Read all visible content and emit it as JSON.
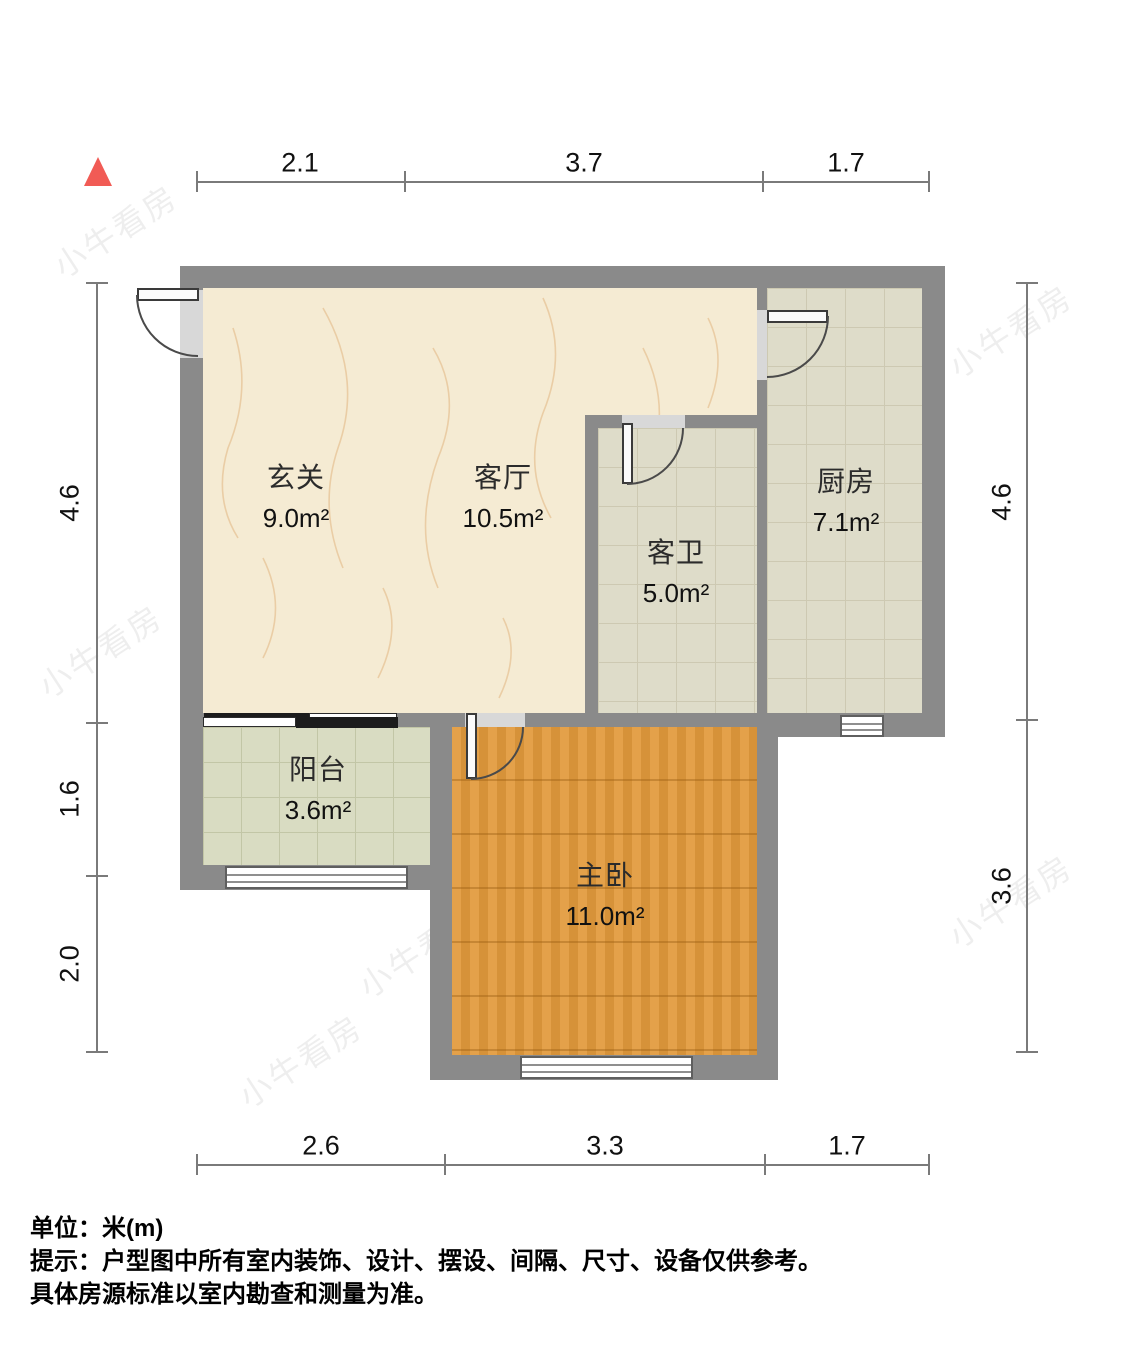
{
  "north_indicator": {
    "color": "#f15b55"
  },
  "dimensions": {
    "top": [
      "2.1",
      "3.7",
      "1.7"
    ],
    "bottom": [
      "2.6",
      "3.3",
      "1.7"
    ],
    "left": [
      "4.6",
      "1.6",
      "2.0"
    ],
    "right": [
      "4.6",
      "3.6"
    ]
  },
  "rooms": [
    {
      "id": "entry",
      "name": "玄关",
      "area": "9.0m²"
    },
    {
      "id": "living",
      "name": "客厅",
      "area": "10.5m²"
    },
    {
      "id": "bath",
      "name": "客卫",
      "area": "5.0m²"
    },
    {
      "id": "kitchen",
      "name": "厨房",
      "area": "7.1m²"
    },
    {
      "id": "balcony",
      "name": "阳台",
      "area": "3.6m²"
    },
    {
      "id": "bedroom",
      "name": "主卧",
      "area": "11.0m²"
    }
  ],
  "watermark": {
    "text": "小牛看房"
  },
  "footer": {
    "units_line": "单位：米(m)",
    "disclaimer_line1": "提示：户型图中所有室内装饰、设计、摆设、间隔、尺寸、设备仅供参考。",
    "disclaimer_line2": "具体房源标准以室内勘查和测量为准。"
  },
  "colors": {
    "wall": "#8a8a8a",
    "living_floor": "#f5ebd3",
    "tile_floor": "#dedcc9",
    "balcony_floor": "#d9dcc2",
    "bedroom_floor": "#e29a3c",
    "north_red": "#f15b55"
  }
}
